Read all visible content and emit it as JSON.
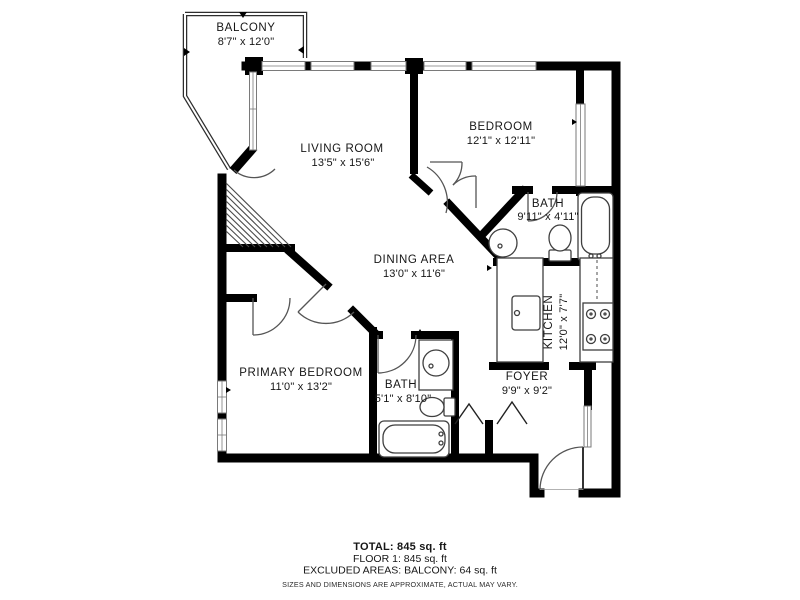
{
  "rooms": [
    {
      "id": "balcony",
      "name": "BALCONY",
      "dims": "8'7\" x 12'0\""
    },
    {
      "id": "living",
      "name": "LIVING ROOM",
      "dims": "13'5\" x 15'6\""
    },
    {
      "id": "bedroom",
      "name": "BEDROOM",
      "dims": "12'1\" x 12'11\""
    },
    {
      "id": "bath1",
      "name": "BATH",
      "dims": "9'11\" x 4'11\""
    },
    {
      "id": "dining",
      "name": "DINING AREA",
      "dims": "13'0\" x 11'6\""
    },
    {
      "id": "kitchen",
      "name": "KITCHEN",
      "dims": "12'0\" x 7'7\""
    },
    {
      "id": "primary",
      "name": "PRIMARY BEDROOM",
      "dims": "11'0\" x 13'2\""
    },
    {
      "id": "bath2",
      "name": "BATH",
      "dims": "5'1\" x 8'10\""
    },
    {
      "id": "foyer",
      "name": "FOYER",
      "dims": "9'9\" x 9'2\""
    }
  ],
  "summary": {
    "total": "TOTAL: 845 sq. ft",
    "floor": "FLOOR 1: 845 sq. ft",
    "excluded": "EXCLUDED AREAS: BALCONY: 64 sq. ft",
    "disclaimer": "SIZES AND DIMENSIONS ARE APPROXIMATE, ACTUAL MAY VARY."
  },
  "colors": {
    "wall": "#000000",
    "thin_line": "#4a4a4a",
    "window_frame": "#7a7a7a",
    "text": "#161616",
    "background": "#ffffff"
  }
}
